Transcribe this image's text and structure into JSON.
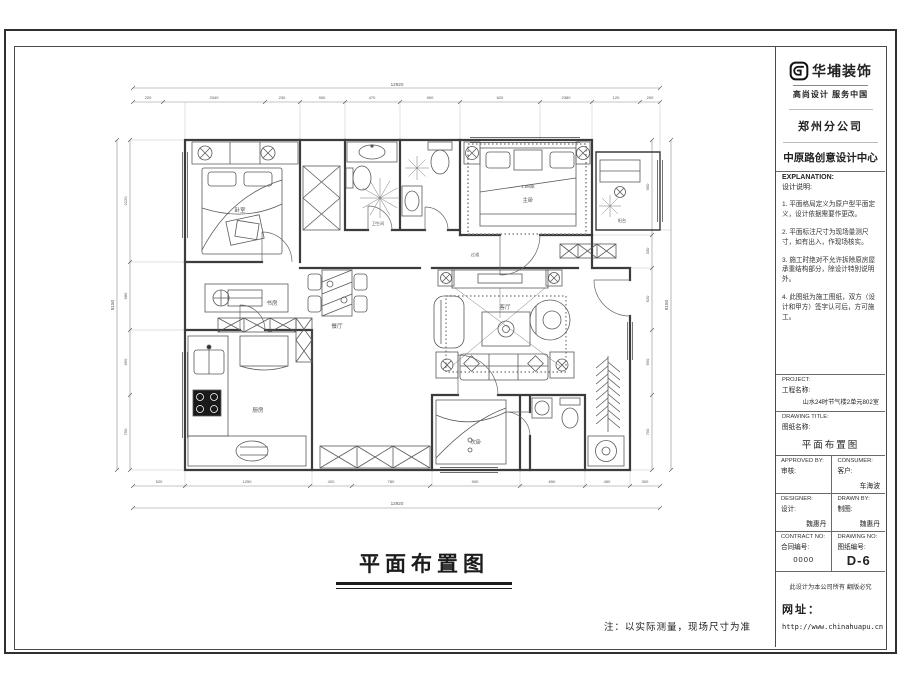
{
  "tb": {
    "company": "华埔装饰",
    "slogan": "高尚设计  服务中国",
    "branch": "郑州分公司",
    "center": "中原路创意设计中心",
    "explanation_en": "EXPLANATION:",
    "explanation_cn": "设计说明:",
    "notes": [
      "1. 平面格局定义为原户型平面定义，设计依据需要作更改。",
      "2. 平面标注尺寸为现场量测尺寸，如有出入，作现场核实。",
      "3. 施工时绝对不允许拆除原房屋承重结构部分，除设计特别说明外。",
      "4. 此图纸为施工图纸，双方（设计和甲方）签字认可后，方可施工。"
    ],
    "project_en": "PROJECT:",
    "project_cn": "工程名称:",
    "project_value": "山水24时节气楼2单元802室",
    "drawing_title_en": "DRAWING TITLE:",
    "drawing_title_cn": "图纸名称:",
    "drawing_title_value": "平面布置图",
    "approved_en": "APPROVED BY:",
    "approved_cn": "审核:",
    "consumer_en": "CONSUMER:",
    "consumer_cn": "客户:",
    "consumer_value": "车海波",
    "designer_en": "DESIGNER:",
    "designer_cn": "设计:",
    "designer_value": "魏惠丹",
    "drawn_en": "DRAWN BY:",
    "drawn_cn": "制图:",
    "drawn_value": "魏惠丹",
    "contract_en": "CONTRACT NO:",
    "contract_cn": "合同编号:",
    "contract_value": "0000",
    "drawing_no_en": "DRAWING NO:",
    "drawing_no_cn": "图纸编号:",
    "drawing_no_value": "D-6",
    "copyright": "此设计为本公司所有 翻版必究",
    "website_label": "网址：",
    "website_url": "http://www.chinahuapu.cn"
  },
  "main": {
    "plan_title": "平面布置图",
    "footnote": "注：以实际测量，现场尺寸为准",
    "room_labels": [
      {
        "text": "卧室"
      },
      {
        "text": "主卧"
      },
      {
        "text": "1.8M床"
      },
      {
        "text": "卫生间"
      },
      {
        "text": "过道"
      },
      {
        "text": "客厅"
      },
      {
        "text": "餐厅"
      },
      {
        "text": "书房"
      },
      {
        "text": "厨房"
      },
      {
        "text": "次卧"
      },
      {
        "text": "阳台"
      }
    ],
    "dims": {
      "top": [
        "220",
        "3340",
        "230",
        "900",
        "470",
        "900",
        "620",
        "2380",
        "120",
        "200"
      ],
      "top_overall": "12920",
      "bottom": [
        "520",
        "1250",
        "420",
        "780",
        "900",
        "650",
        "450",
        "300"
      ],
      "bottom_overall": "12920",
      "left": [
        "2220",
        "680",
        "650",
        "750"
      ],
      "left_overall": "8150",
      "right": [
        "950",
        "330",
        "620",
        "650",
        "750"
      ],
      "right_overall": "8150"
    },
    "colors": {
      "wall": "#3c3c3c",
      "furniture": "#5a5a5a",
      "dimension": "#8a8a8a"
    }
  }
}
